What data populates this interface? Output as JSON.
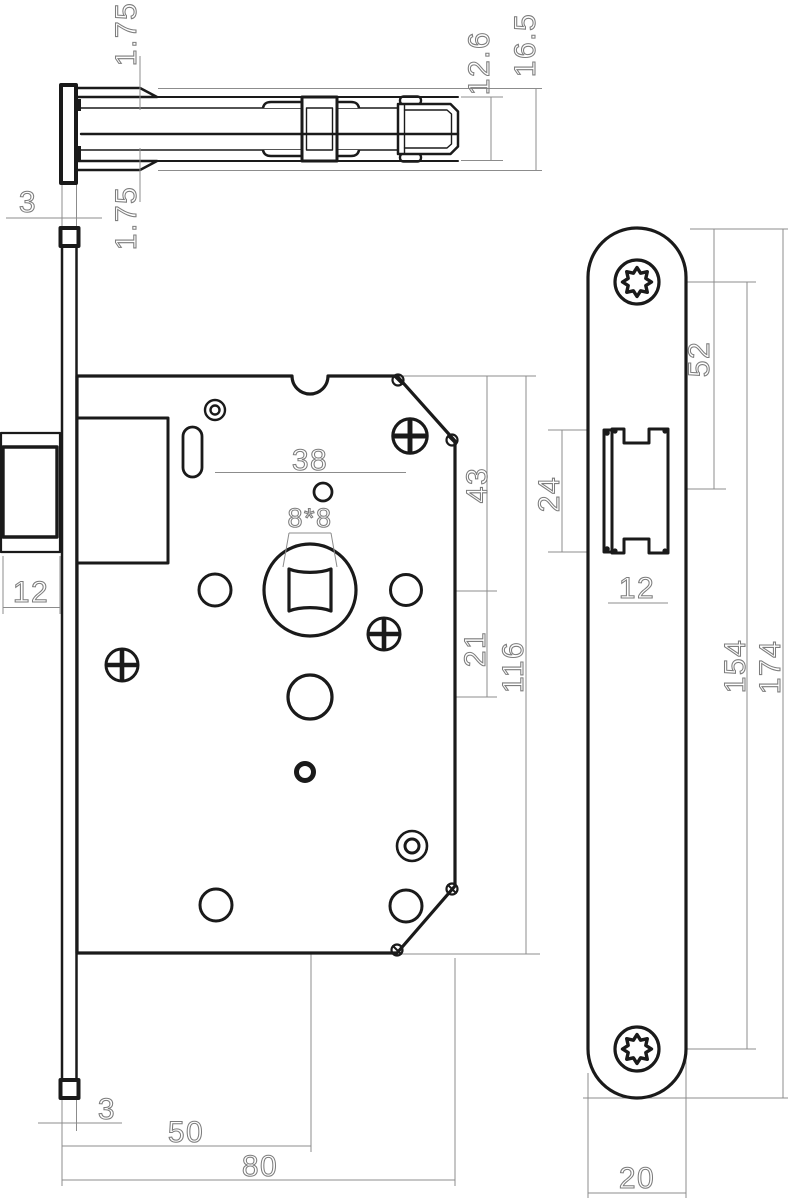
{
  "drawing": {
    "kind": "mortise-lock technical drawing, three orthographic views",
    "colors": {
      "outline": "#1a1a1a",
      "dimension": "#8c8c8c",
      "background": "#ffffff"
    },
    "dims": {
      "top": {
        "gap_top": "1.75",
        "gap_bottom": "1.75",
        "plate_thickness": "3",
        "latch_height": "12.6",
        "total_height": "16.5"
      },
      "front": {
        "hole_spacing": "38",
        "spindle": "8*8",
        "top_to_spindle": "43",
        "spindle_to_hole": "21",
        "case_height": "116",
        "latch_width": "12",
        "plate_thickness": "3",
        "backset": "50",
        "depth": "80"
      },
      "side": {
        "top_to_latch": "52",
        "latch_height": "24",
        "latch_width": "12",
        "screw_spacing": "154",
        "plate_length": "174",
        "plate_width": "20"
      }
    }
  }
}
